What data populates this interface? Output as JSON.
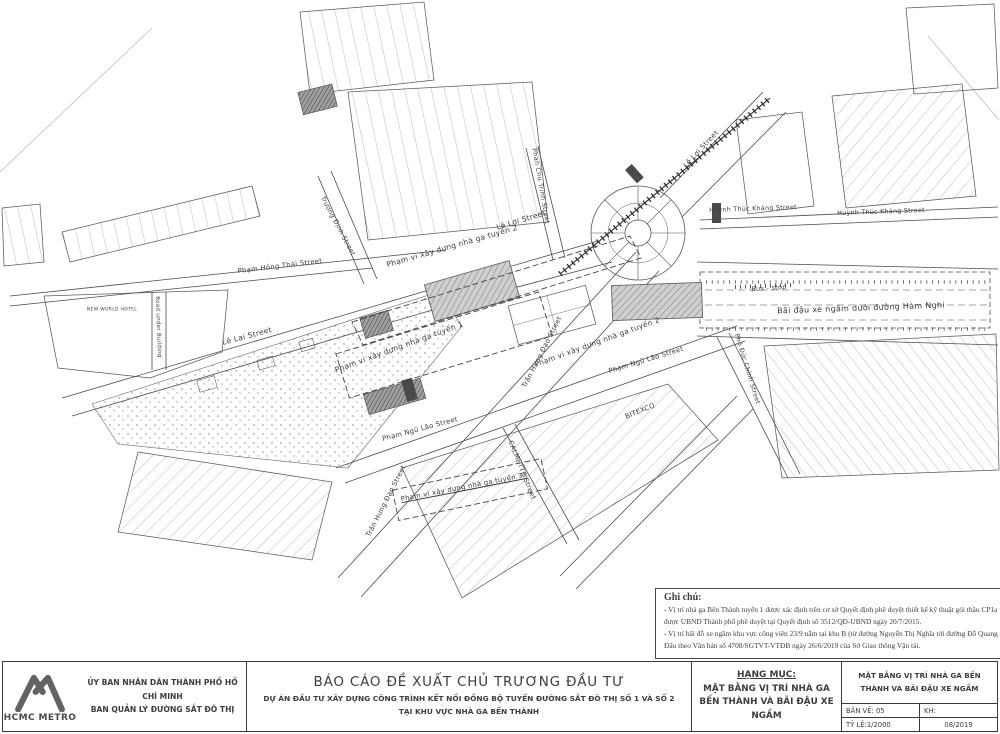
{
  "title_block": {
    "logo_text": "HCMC METRO",
    "agency_line1": "ỦY BAN NHÂN DÂN THÀNH PHỐ HỒ CHÍ MINH",
    "agency_line2": "BAN QUẢN LÝ ĐƯỜNG SẮT ĐÔ THỊ",
    "report_title": "BÁO CÁO ĐỀ XUẤT CHỦ TRƯƠNG ĐẦU TƯ",
    "project_line1": "DỰ ÁN ĐẦU TƯ XÂY DỰNG CÔNG TRÌNH KẾT NỐI ĐỒNG BỘ TUYẾN ĐƯỜNG SẮT ĐÔ THỊ SỐ 1 VÀ SỐ 2",
    "project_line2": "TẠI KHU VỰC NHÀ GA BẾN THÀNH",
    "hang_muc_label": "HẠNG MỤC:",
    "hang_muc_value": "MẶT BẰNG VỊ TRÍ NHÀ GA BẾN THÀNH VÀ BÃI ĐẬU XE NGẦM",
    "drawing_title": "MẶT BẰNG VỊ TRÍ NHÀ GA BẾN THÀNH VÀ BÃI ĐẬU XE NGẦM",
    "ban_ve": "BẢN VẼ: 05",
    "kh": "KH:",
    "ty_le": "TỶ LỆ:1/2000",
    "date": "08/2019"
  },
  "notes": {
    "title": "Ghi chú:",
    "line1": "- Vị trí nhà ga Bến Thành tuyến 1 được xác định trên cơ sở Quyết định phê duyệt thiết kế kỹ thuật gói thầu CP1a được UBND Thành phố phê duyệt tại Quyết định số 3512/QĐ-UBND ngày 20/7/2015.",
    "line2": "- Vị trí bãi đỗ xe ngầm khu vực công viên 23/9 nằm tại khu B (từ đường Nguyễn Thị Nghĩa tới đường Đỗ Quang Đẩu theo Văn bản số 4708/SGTVT-VTĐB ngày 26/6/2019 của Sở Giao thông Vận tải."
  },
  "map": {
    "labels": [
      {
        "name": "street-label-truong-dinh",
        "text": "Trương Định Street",
        "x": 338,
        "y": 226,
        "r": 62,
        "s": 6.5
      },
      {
        "name": "street-label-pham-hong-thai",
        "text": "Phạm Hồng Thái Street",
        "x": 280,
        "y": 266,
        "r": -7,
        "s": 6.8
      },
      {
        "name": "street-label-le-lai",
        "text": "Lê Lai Street",
        "x": 247,
        "y": 336,
        "r": -15,
        "s": 7.5
      },
      {
        "name": "street-label-le-loi-west",
        "text": "Lê Lợi Street",
        "x": 521,
        "y": 220,
        "r": -17,
        "s": 7.5
      },
      {
        "name": "street-label-phan-chu-trinh",
        "text": "Phan Chu Trinh Street",
        "x": 541,
        "y": 186,
        "r": 80,
        "s": 6.5
      },
      {
        "name": "scope-label-line2-west",
        "text": "Phạm vi xây dựng nhà ga tuyến 2",
        "x": 452,
        "y": 246,
        "r": -16,
        "s": 7.5
      },
      {
        "name": "street-label-le-loi-ne",
        "text": "Lê Lợi Street",
        "x": 701,
        "y": 149,
        "r": -47,
        "s": 7
      },
      {
        "name": "street-label-huynh-thuc-khang-1",
        "text": "Huỳnh Thúc Kháng Street",
        "x": 753,
        "y": 209,
        "r": -2,
        "s": 6.3
      },
      {
        "name": "street-label-huynh-thuc-khang-2",
        "text": "Huỳnh Thúc Kháng Street",
        "x": 881,
        "y": 212,
        "r": -2,
        "s": 6.3
      },
      {
        "name": "bus-stop-label",
        "text": "Bus - stop",
        "x": 769,
        "y": 288,
        "r": -4,
        "s": 6.5,
        "it": true
      },
      {
        "name": "parking-label-ham-nghi",
        "text": "Bãi đậu xe ngầm dưới đường Hàm Nghi",
        "x": 861,
        "y": 308,
        "r": -2,
        "s": 8
      },
      {
        "name": "scope-label-line1",
        "text": "Phạm vi xây dựng nhà ga tuyến 1",
        "x": 399,
        "y": 347,
        "r": -20,
        "s": 7.5
      },
      {
        "name": "street-label-tran-hung-dao-upper",
        "text": "Trần Hưng Đạo Street",
        "x": 542,
        "y": 352,
        "r": -63,
        "s": 6.8
      },
      {
        "name": "scope-label-line2-south",
        "text": "Phạm vi xây dựng nhà ga tuyến 2",
        "x": 597,
        "y": 342,
        "r": -20,
        "s": 7.3
      },
      {
        "name": "street-label-pham-ngu-lao-east",
        "text": "Phạm Ngũ Lão Street",
        "x": 646,
        "y": 360,
        "r": -17,
        "s": 6.8
      },
      {
        "name": "street-label-pho-duc-chinh",
        "text": "Phó Đức Chính Street",
        "x": 747,
        "y": 369,
        "r": 73,
        "s": 6.3
      },
      {
        "name": "building-label-bitexco",
        "text": "BITEXCO",
        "x": 640,
        "y": 411,
        "r": -22,
        "s": 6.8
      },
      {
        "name": "street-label-pham-ngu-lao-west",
        "text": "Phạm Ngũ Lão Street",
        "x": 420,
        "y": 429,
        "r": -15,
        "s": 6.8
      },
      {
        "name": "street-label-tran-hung-dao-lower",
        "text": "Trần Hưng Đạo Street",
        "x": 386,
        "y": 501,
        "r": -63,
        "s": 6.8
      },
      {
        "name": "street-label-calmette",
        "text": "CALMETTE Street",
        "x": 522,
        "y": 470,
        "r": 68,
        "s": 6.8
      },
      {
        "name": "scope-label-line3a",
        "text": "Phạm vi xây dựng nhà ga tuyến 3a",
        "x": 464,
        "y": 487,
        "r": -11,
        "s": 6.8,
        "u": true
      },
      {
        "name": "road-under-building-label",
        "text": "Road under Building",
        "x": 158,
        "y": 327,
        "r": 88,
        "s": 5.5
      },
      {
        "name": "building-label-new-world-hotel",
        "text": "NEW WORLD HOTEL",
        "x": 112,
        "y": 310,
        "r": 0,
        "s": 4.5
      }
    ]
  }
}
